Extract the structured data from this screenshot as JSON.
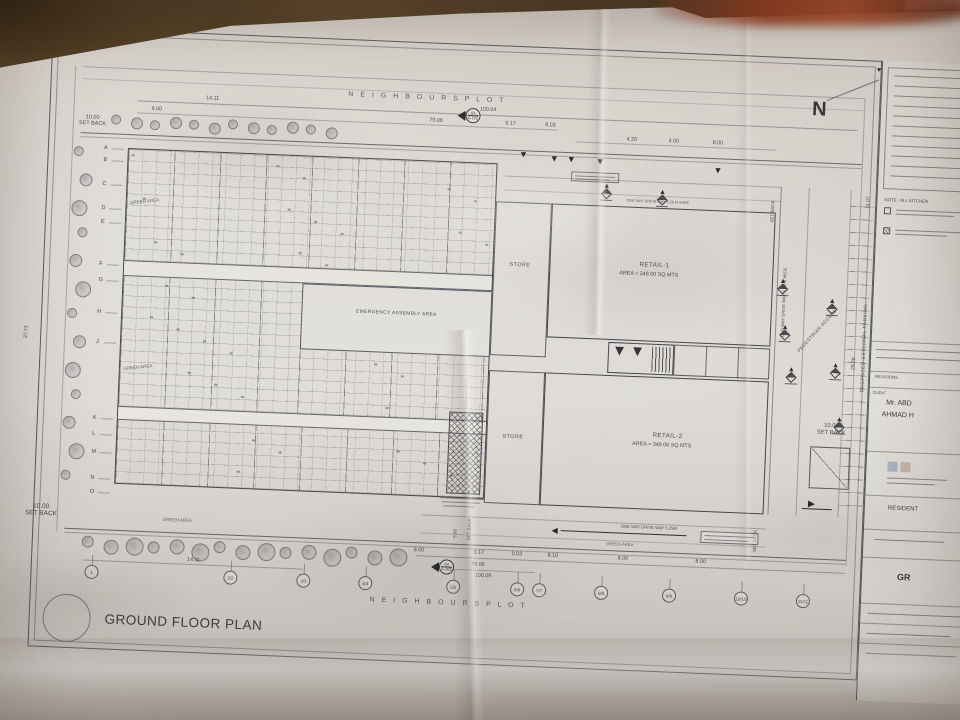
{
  "scene": {
    "description": "Photograph of an architectural blueprint sheet pinned on a brown board",
    "board_color": "#5e462c",
    "paper_color": "#dcd9d4",
    "ink_color": "#4a4a52"
  },
  "plan": {
    "sheet_title": "GROUND FLOOR PLAN",
    "north_label": "N",
    "plot_label_top": "N E I G H B O U R S   P L O T",
    "plot_label_bottom": "N E I G H B O U R S   P L O T",
    "retail1_name": "RETAIL-1",
    "retail1_area": "AREA = 349.00 SQ MTS",
    "retail2_name": "RETAIL-2",
    "retail2_area": "AREA = 349.06 SQ MTS",
    "store_top": "STORE",
    "store_bottom": "STORE",
    "emergency_area": "EMERGENCY ASSEMBLY AREA",
    "green_area": "GREEN AREA",
    "setback_value_10": "10.00",
    "setback_value_5": "5.00",
    "setback_word": "SET BACK",
    "driveway_top": "ONE WAY DRIVE WAY 5.25 M WIDE",
    "driveway_bottom": "ONE WAY DRIVE WAY 5.25M",
    "driveway_right": "ONE WAY DRIVE WAY 5.25 M WIDE",
    "pedestrian": "PEDESTRIAN ACCESS",
    "parking": "PROPOSED EXTERNAL PARKING",
    "section_marker": {
      "top": "64",
      "bottom": "A-102"
    },
    "dims_top": [
      "14.11",
      "8.00",
      "100.04",
      "79.06",
      "9.17",
      "8.03",
      "4.20",
      "4.00",
      "8.00"
    ],
    "dims_bottom": [
      "8.00",
      "9.17",
      "0.03",
      "8.10",
      "8.00",
      "8.00",
      "79.06",
      "100.09",
      "14.11"
    ],
    "dims_left": [
      "27.73"
    ],
    "dims_right": [
      "11.07",
      "29.28"
    ],
    "grid_bottom": [
      "1",
      "2/2",
      "3/3",
      "4/4",
      "5/5",
      "6/6",
      "7/7",
      "8/8",
      "9/9",
      "10/10",
      "11/11"
    ],
    "grid_left": [
      "A",
      "B",
      "C",
      "D",
      "E",
      "F",
      "G",
      "H",
      "J",
      "K",
      "L",
      "M",
      "N",
      "O"
    ]
  },
  "title_block": {
    "note_text": "NOTE : ALL KITCHEN",
    "revisions_label": "REVISIONS",
    "client_label": "CLIENT",
    "client_line1": "Mr. ABD",
    "client_line2": "AHMAD H",
    "project_text": "RESIDENT",
    "sheet_text": "GR"
  }
}
